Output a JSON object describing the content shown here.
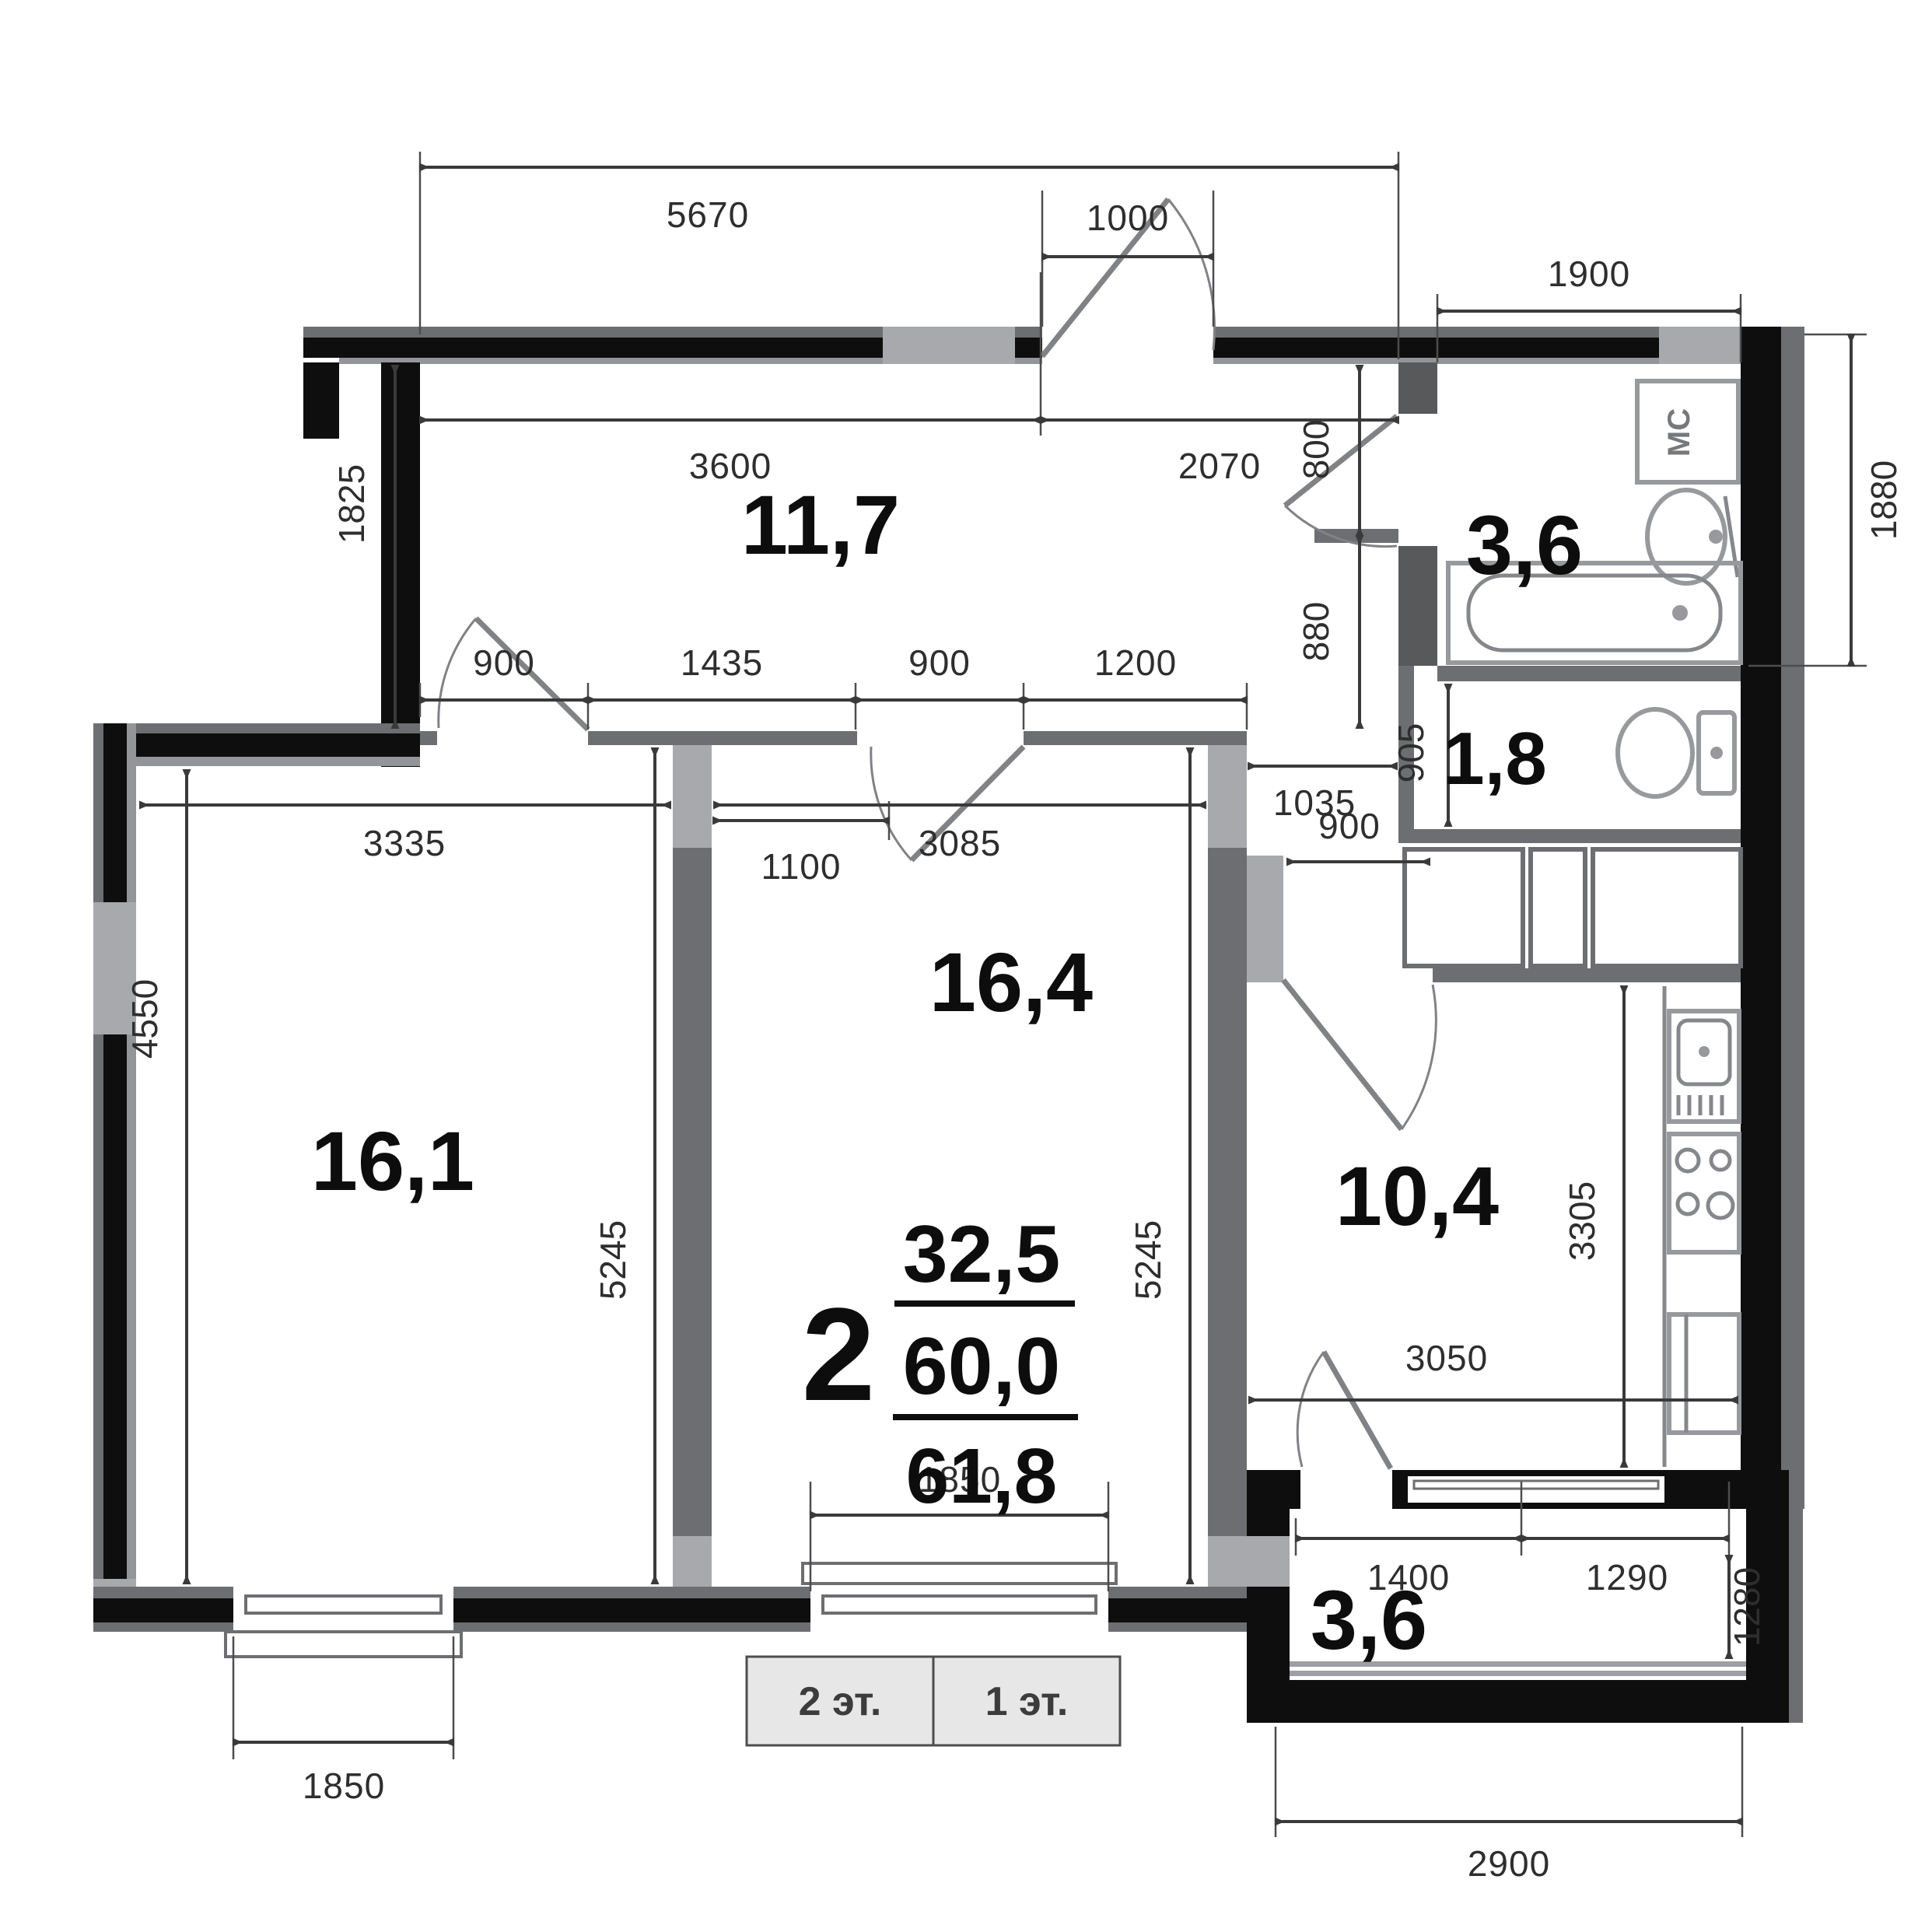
{
  "plan": {
    "title": "apartment floor plan",
    "apartment_info": {
      "rooms_count": "2",
      "living_area": "32,5",
      "floor_area": "60,0",
      "total_area": "61,8"
    },
    "rooms": {
      "hallway_area": "11,7",
      "bathroom_area": "3,6",
      "toilet_area": "1,8",
      "bedroom_area": "16,4",
      "living_area": "16,1",
      "kitchen_area": "10,4",
      "balcony_area": "3,6"
    },
    "fixtures": {
      "washing_machine_label": "МС"
    },
    "floor_tabs": [
      {
        "label": "2 эт."
      },
      {
        "label": "1 эт."
      }
    ],
    "dims": {
      "d5670": "5670",
      "d1000": "1000",
      "d1900": "1900",
      "d3600": "3600",
      "d2070": "2070",
      "d1825": "1825",
      "d800": "800",
      "d880": "880",
      "d1880": "1880",
      "dc900a": "900",
      "dc1435": "1435",
      "dc900b": "900",
      "dc1200": "1200",
      "d1100": "1100",
      "d1035": "1035",
      "d905": "905",
      "d900k": "900",
      "d3335": "3335",
      "d3085": "3085",
      "d4550": "4550",
      "d5245a": "5245",
      "d5245b": "5245",
      "d3305": "3305",
      "d3050": "3050",
      "d1850a": "1850",
      "d1850b": "1850",
      "d1400": "1400",
      "d1290": "1290",
      "d1280": "1280",
      "d2900": "2900"
    },
    "colors": {
      "wall_black": "#0e0e0e",
      "wall_gray": "#6d6e71",
      "wall_light": "#a7a9ac",
      "tab_bg": "#e7e7e7"
    }
  }
}
